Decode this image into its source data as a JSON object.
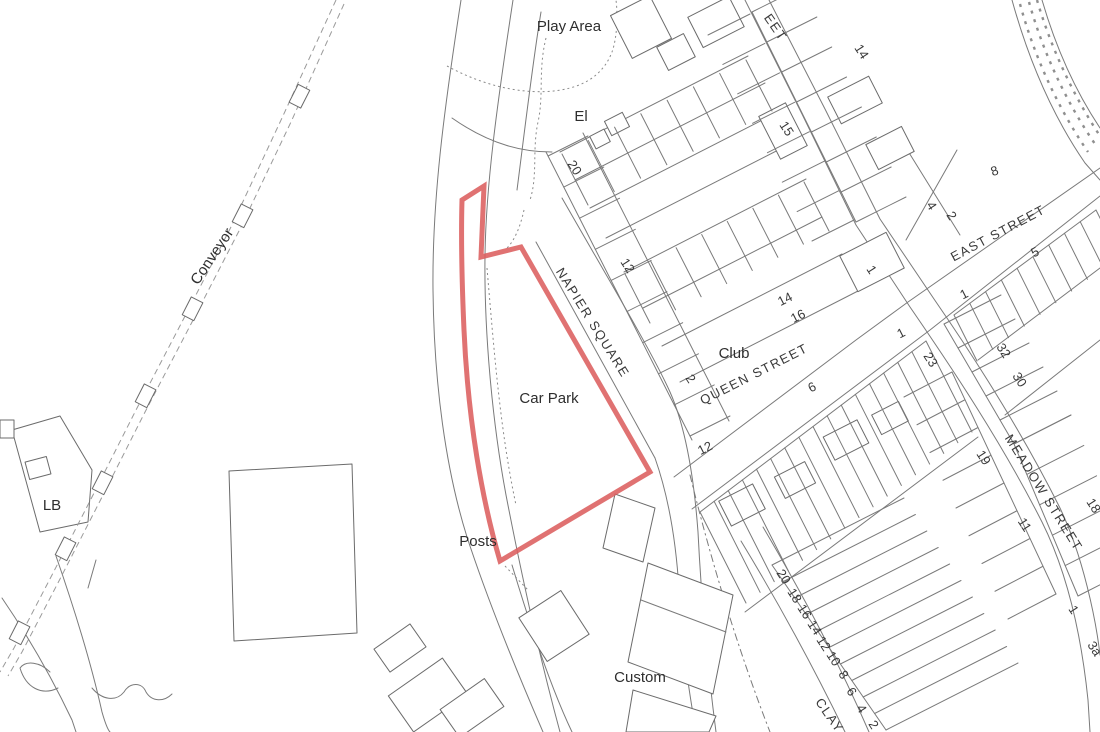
{
  "map": {
    "colors": {
      "background": "#ffffff",
      "linework": "#7a7a7a",
      "text": "#2e2e2e",
      "site_boundary": "#dc5e5e"
    },
    "labels": {
      "features": [
        {
          "text": "Play Area",
          "x": 569,
          "y": 31,
          "rot": 0
        },
        {
          "text": "El",
          "x": 581,
          "y": 121,
          "rot": 0
        },
        {
          "text": "Club",
          "x": 734,
          "y": 358,
          "rot": 0
        },
        {
          "text": "Car Park",
          "x": 549,
          "y": 403,
          "rot": 0
        },
        {
          "text": "Posts",
          "x": 478,
          "y": 546,
          "rot": 0
        },
        {
          "text": "Custom",
          "x": 640,
          "y": 682,
          "rot": 0
        },
        {
          "text": "LB",
          "x": 52,
          "y": 510,
          "rot": 0
        },
        {
          "text": "Conveyor",
          "x": 216,
          "y": 259,
          "rot": -56
        }
      ],
      "streets": [
        {
          "text": "NAPIER SQUARE",
          "x": 589,
          "y": 325,
          "rot": 58
        },
        {
          "text": "QUEEN STREET",
          "x": 756,
          "y": 378,
          "rot": -27
        },
        {
          "text": "EAST STREET",
          "x": 1000,
          "y": 237,
          "rot": -28
        },
        {
          "text": "MEADOW STREET",
          "x": 1040,
          "y": 495,
          "rot": 58
        },
        {
          "text": "CLAY",
          "x": 826,
          "y": 718,
          "rot": 55
        },
        {
          "text": "EET",
          "x": 772,
          "y": 30,
          "rot": 55
        }
      ],
      "house_numbers": [
        {
          "text": "20",
          "x": 571,
          "y": 170,
          "rot": 57
        },
        {
          "text": "12",
          "x": 624,
          "y": 268,
          "rot": 57
        },
        {
          "text": "2",
          "x": 687,
          "y": 381,
          "rot": 57
        },
        {
          "text": "15",
          "x": 783,
          "y": 131,
          "rot": 57
        },
        {
          "text": "14",
          "x": 858,
          "y": 54,
          "rot": 57
        },
        {
          "text": "1",
          "x": 868,
          "y": 272,
          "rot": 57
        },
        {
          "text": "14",
          "x": 787,
          "y": 303,
          "rot": -27
        },
        {
          "text": "16",
          "x": 800,
          "y": 320,
          "rot": -27
        },
        {
          "text": "4",
          "x": 928,
          "y": 208,
          "rot": 57
        },
        {
          "text": "2",
          "x": 948,
          "y": 218,
          "rot": 57
        },
        {
          "text": "8",
          "x": 996,
          "y": 175,
          "rot": -20
        },
        {
          "text": "1",
          "x": 903,
          "y": 337,
          "rot": -27
        },
        {
          "text": "23",
          "x": 927,
          "y": 362,
          "rot": 57
        },
        {
          "text": "1",
          "x": 966,
          "y": 298,
          "rot": -27
        },
        {
          "text": "5",
          "x": 1037,
          "y": 256,
          "rot": -27
        },
        {
          "text": "32",
          "x": 1000,
          "y": 353,
          "rot": 57
        },
        {
          "text": "30",
          "x": 1016,
          "y": 382,
          "rot": 57
        },
        {
          "text": "19",
          "x": 980,
          "y": 460,
          "rot": 57
        },
        {
          "text": "11",
          "x": 1021,
          "y": 527,
          "rot": 57
        },
        {
          "text": "18",
          "x": 1090,
          "y": 508,
          "rot": 57
        },
        {
          "text": "1",
          "x": 1070,
          "y": 612,
          "rot": 57
        },
        {
          "text": "3a",
          "x": 1091,
          "y": 651,
          "rot": 57
        },
        {
          "text": "12",
          "x": 707,
          "y": 452,
          "rot": -27
        },
        {
          "text": "6",
          "x": 814,
          "y": 391,
          "rot": -27
        },
        {
          "text": "20",
          "x": 780,
          "y": 579,
          "rot": 57
        },
        {
          "text": "18",
          "x": 791,
          "y": 598,
          "rot": 57
        },
        {
          "text": "16",
          "x": 801,
          "y": 614,
          "rot": 57
        },
        {
          "text": "14",
          "x": 811,
          "y": 630,
          "rot": 57
        },
        {
          "text": "12",
          "x": 820,
          "y": 646,
          "rot": 57
        },
        {
          "text": "10",
          "x": 830,
          "y": 661,
          "rot": 57
        },
        {
          "text": "8",
          "x": 840,
          "y": 677,
          "rot": 57
        },
        {
          "text": "6",
          "x": 848,
          "y": 694,
          "rot": 57
        },
        {
          "text": "4",
          "x": 858,
          "y": 711,
          "rot": 57
        },
        {
          "text": "2",
          "x": 870,
          "y": 727,
          "rot": 57
        }
      ]
    }
  }
}
